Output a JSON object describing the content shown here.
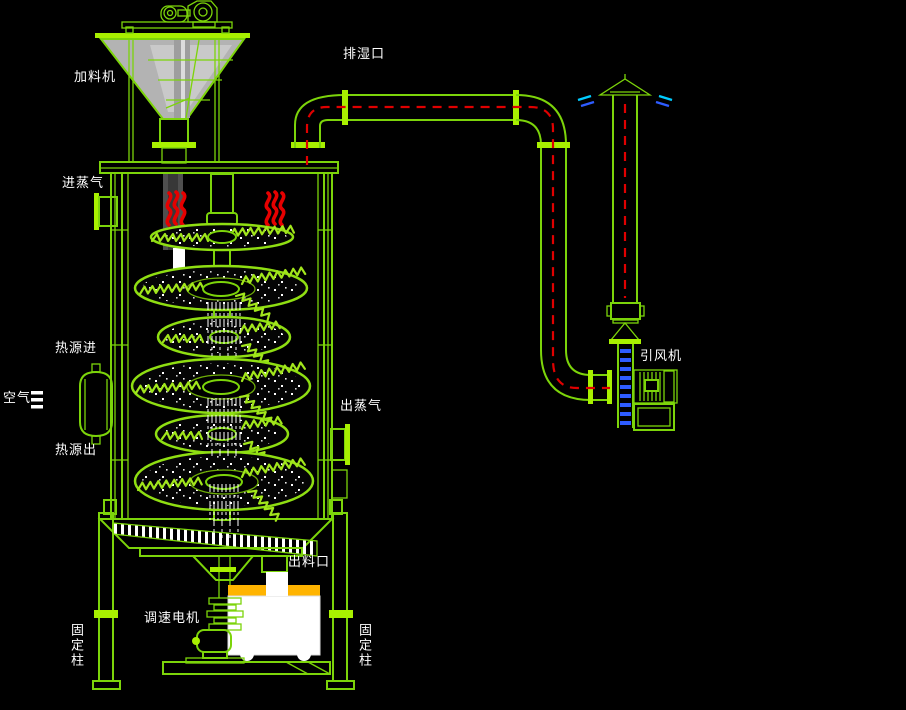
{
  "labels": {
    "feeder": "加料机",
    "exhaust_port": "排湿口",
    "steam_in": "进蒸气",
    "heat_in": "热源进",
    "air": "空气",
    "steam_out": "出蒸气",
    "heat_out": "热源出",
    "fan": "引风机",
    "discharge_port": "出料口",
    "speed_motor": "调速电机",
    "fixed_column_left": "固定柱",
    "fixed_column_right": "固定柱"
  },
  "icons": {
    "heat_wave": "three-red-wavy-lines",
    "air_symbol": "three-white-bars",
    "vent_cap": "cone-rain-cap",
    "flow_centerline": "red-dashed-line",
    "flex_duct": "blue-striped-duct"
  },
  "colors": {
    "background": "#000000",
    "line_green": "#7CD40A",
    "bright_green": "#A8F000",
    "rake_green": "#A2E61C",
    "heat_red": "#E60000",
    "centerline_red": "#E00000",
    "duct_blue": "#2E5CFF",
    "vent_cyan": "#00CCFF",
    "cart_orange": "#FFB400",
    "hopper_gray": "#B3B3B3",
    "text_white": "#FFFFFF"
  }
}
